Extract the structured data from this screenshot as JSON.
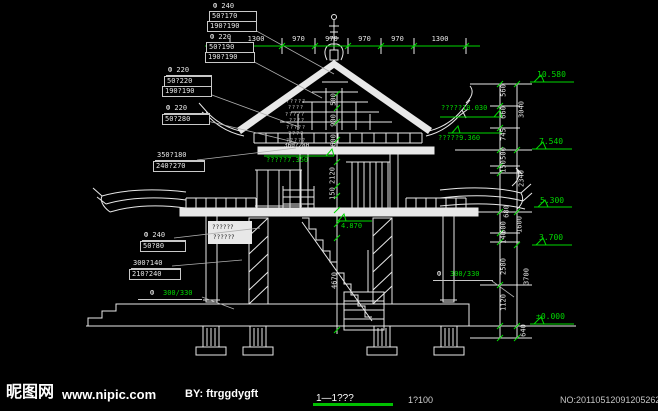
{
  "callouts": {
    "s1": [
      "Ф  240",
      "50?170",
      "190?190"
    ],
    "s2": [
      "Ф  220",
      "50?190",
      "190?190"
    ],
    "s3": [
      "Ф  220",
      "50?220",
      "190?190"
    ],
    "s4": [
      "Ф  220",
      "50?280"
    ],
    "s5": [
      "350?180",
      "240?270"
    ],
    "s6": [
      "Ф  240",
      "50?80"
    ],
    "s7": [
      "300?140",
      "210?240"
    ],
    "s8_prefix": "Ф",
    "s8_value": "300/330",
    "s9_prefix": "Ф",
    "s9_value": "300/330",
    "beam_upper": "360?280",
    "beam_lower": "340?400",
    "wall_notes": [
      "??????",
      "??????"
    ],
    "roof_notes": [
      "?????",
      "????",
      "?????",
      "????",
      "?????",
      "????",
      "?????"
    ]
  },
  "top_dims": [
    "1300",
    "970",
    "970",
    "970",
    "970",
    "1300"
  ],
  "right_dims_inner": [
    "560",
    "660",
    "745",
    "500",
    "150",
    "680",
    "500",
    "140",
    "2580",
    "1120"
  ],
  "right_dims_outer": [
    "3040",
    "2340",
    "1600",
    "3700",
    "640"
  ],
  "center_dims": [
    "500",
    "900",
    "600",
    "2120",
    "150",
    "4670"
  ],
  "elevations": [
    "10.580",
    "7.540",
    "5.300",
    "3.700",
    "±0.000"
  ],
  "level_notes": {
    "attic": "?????10.030",
    "eave": "?????9.360",
    "floor2": "?????7.350",
    "stair": "4.870"
  },
  "footer": {
    "title": "1—1???",
    "scale": "1?100",
    "site": "昵图网",
    "url": "www.nipic.com",
    "author": "BY: ftrggdygft",
    "serial": "NO:20110512091205262000"
  }
}
